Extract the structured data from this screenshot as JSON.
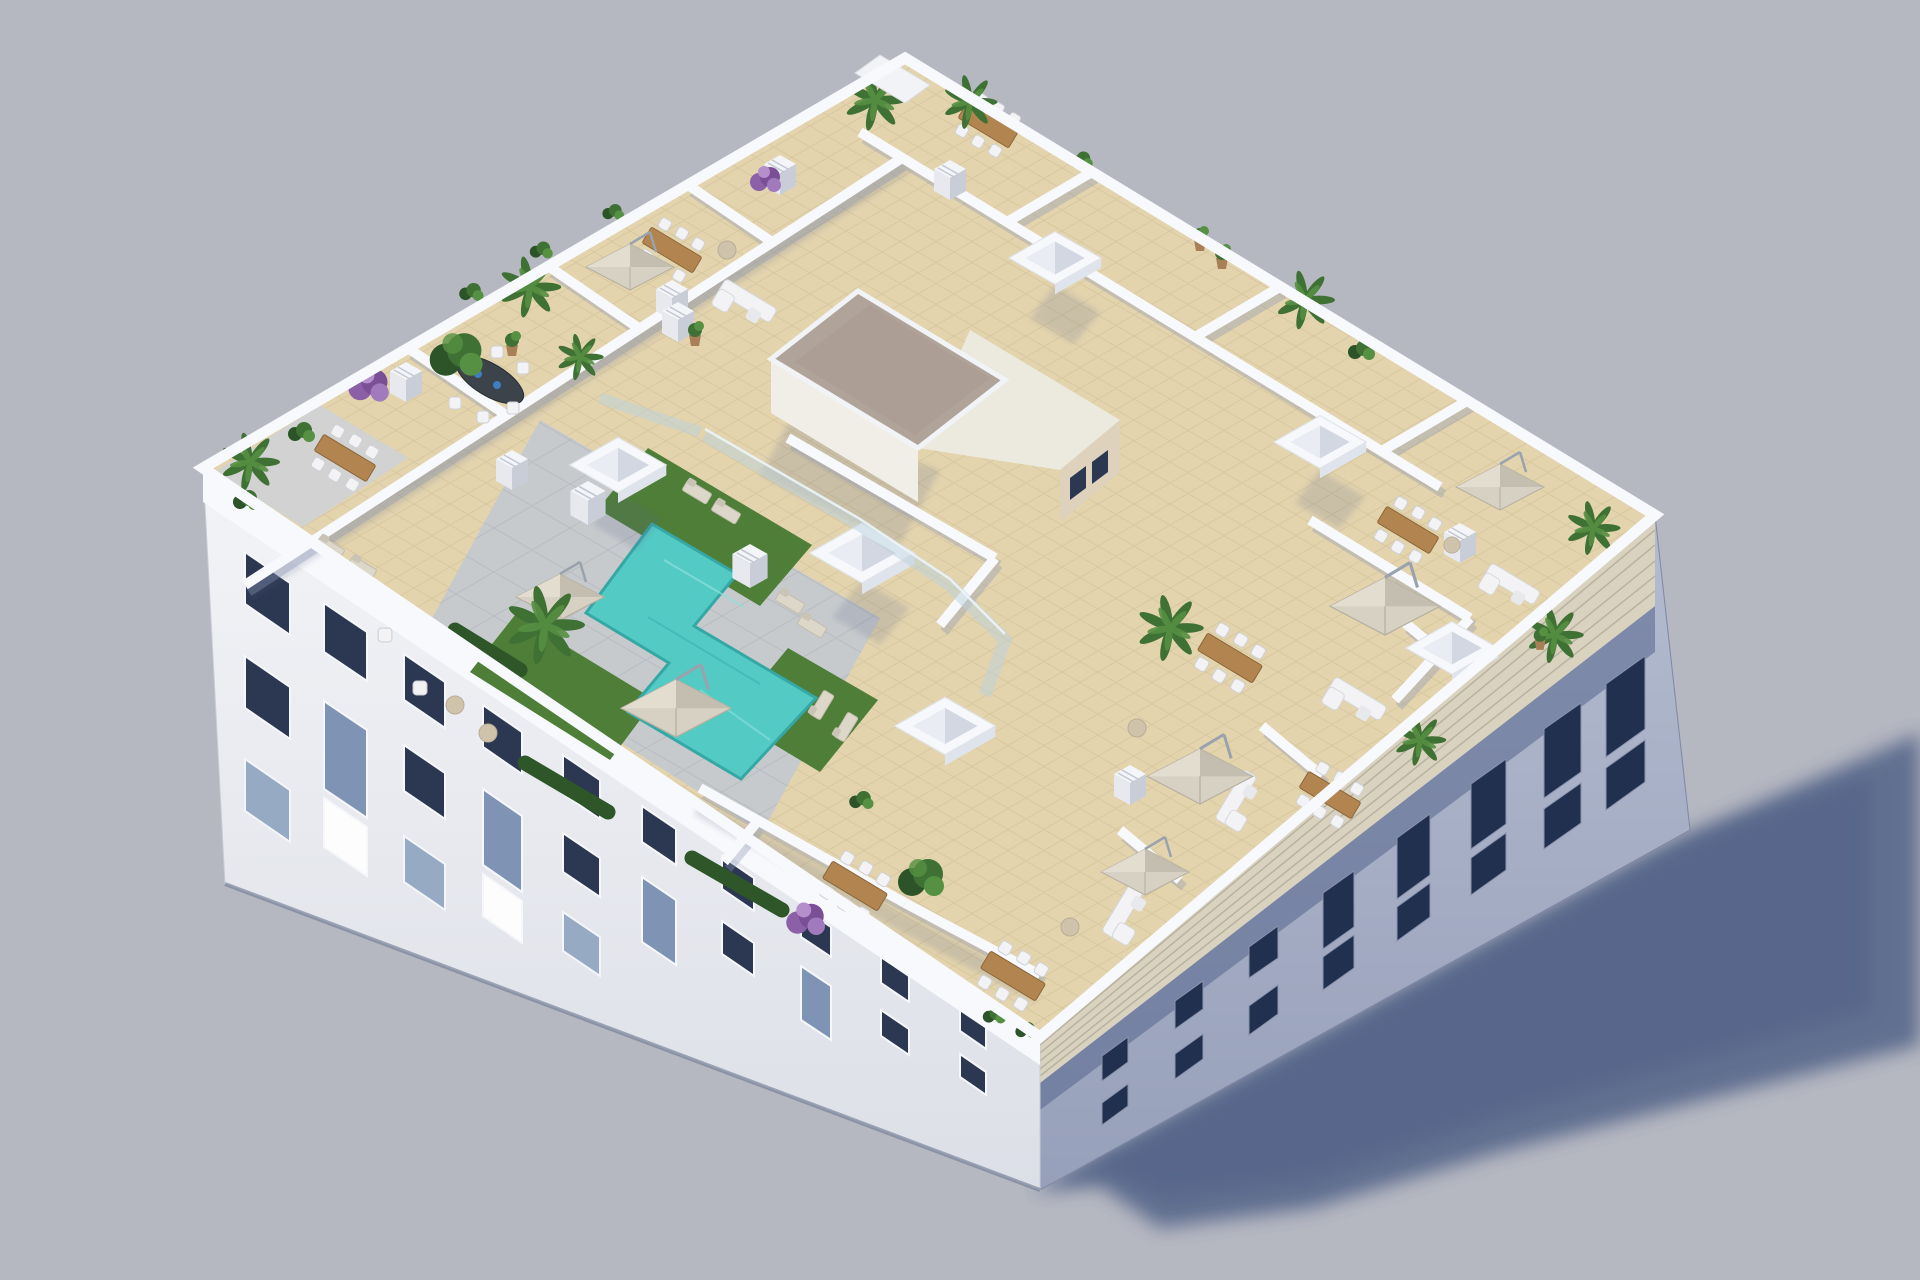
{
  "meta": {
    "type": "3d-architectural-rendering",
    "subject": "Aerial 3D render of an apartment building rooftop with communal pool terrace",
    "no_visible_text": true
  },
  "scene": {
    "description": "Photorealistic aerial 3D rendering of a rectangular low-rise white apartment building viewed from above at a three-quarter angle on a plain grey studio backdrop. The flat roof is divided by low white parapet walls into private beige-tiled terraces surrounding a central communal area with an L-shaped turquoise swimming pool, grey sun deck, artificial-grass patches with loungers, curved glass balustrades and cantilever parasols. A central stair core has a gravel-covered roof; white pyramid skylight boxes and slotted chimney stacks dot the rooftop, which is furnished with wooden dining sets, white sofas, poufs, potted palms, olive trees and purple bougainvillea. The sunlit south-west facade shows rows of dark glazed windows and balconies; the shaded south-east facade carries a slatted timber brise-soleil strip below the parapet. The building casts a long soft blue-grey shadow on the ground to the lower right.",
    "background": "uniform light grey-lavender backdrop, ground and sky identical",
    "light_direction": "sunlight from the upper left",
    "view": "isometric-style aerial three-quarter view, building rotated with corners toward top, right, bottom and left"
  },
  "colors": {
    "sky": "#b5b7c1",
    "ground_shadow": "#4f6086",
    "wall_sunlit": "#eef0f4",
    "wall_bright": "#f8f9fc",
    "wall_shadow": "#a9b1c7",
    "window_dark": "#2c3852",
    "window_shadow": "#223050",
    "glass": "#a8c3d6",
    "tile": "#e3d4ae",
    "tile_line": "#cfc096",
    "deck": "#c7cacd",
    "deck_line": "#b4b7bb",
    "pool": "#54cac5",
    "pool_deep": "#35a8a6",
    "grass": "#4e7e37",
    "hedge": "#2e5629",
    "gravel": "#b0a399",
    "louver": "#d8d2bf",
    "umbrella": "#d7d1c3",
    "umbrella_shade": "#c1bbad",
    "wood": "#b28550",
    "furniture_white": "#f3f3f5",
    "plant_dark": "#2d5429",
    "plant_mid": "#3f7034",
    "plant_light": "#569042",
    "purple": "#8c60a8",
    "pot": "#a97f58",
    "beige_wall": "#ded2bd"
  },
  "building": {
    "storeys_visible": 3,
    "facade_southwest": "sunlit white facade with three stepped rows of dark glazed windows and recessed balconies",
    "facade_southeast": "shaded blue-grey facade with slatted brise-soleil strip under the parapet and glazed balconies",
    "roof_parapet": "continuous white parapet around the whole roof"
  },
  "rooftop": {
    "zones": [
      "perimeter private terraces",
      "communal pool deck",
      "central stair core"
    ],
    "features": [
      {
        "name": "L-shaped swimming pool",
        "count": 1
      },
      {
        "name": "pyramid skylight box",
        "count": 6
      },
      {
        "name": "cantilever parasol",
        "count": 7
      },
      {
        "name": "outdoor dining set",
        "count": 8
      },
      {
        "name": "dark oval dining table",
        "count": 1
      },
      {
        "name": "outdoor sofa",
        "count": 5
      },
      {
        "name": "sun lounger",
        "count": 8
      },
      {
        "name": "chimney vent stack",
        "count": 9
      },
      {
        "name": "artificial grass patch",
        "count": 3
      },
      {
        "name": "glass pool balustrade",
        "count": 1
      },
      {
        "name": "gravel stair-core roof",
        "count": 1
      }
    ]
  },
  "vegetation": [
    "fan palms",
    "banana plants",
    "olive trees",
    "boxwood hedges",
    "purple bougainvillea",
    "potted shrubs"
  ]
}
